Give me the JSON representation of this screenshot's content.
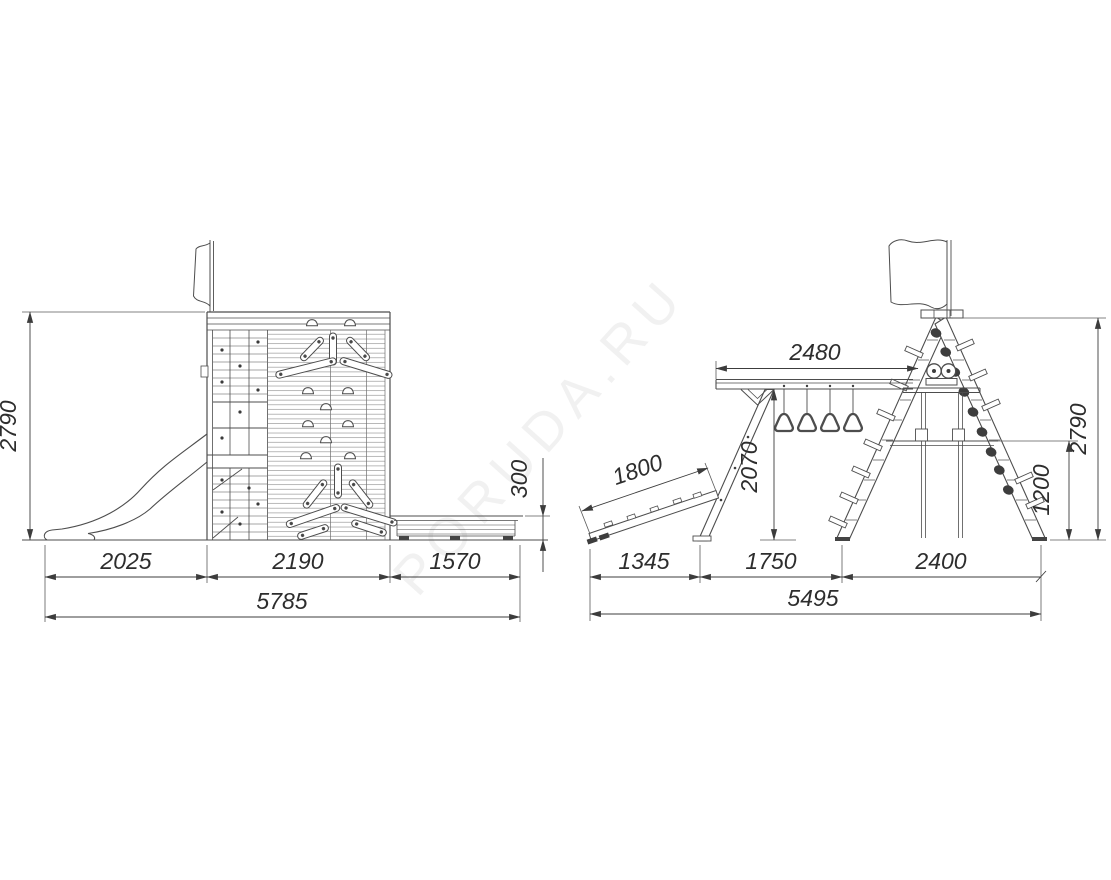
{
  "drawing": {
    "watermark": "PORUDA.RU",
    "side_view": {
      "overall_height": "2790",
      "slide_zone_length": "2025",
      "tower_width": "2190",
      "bench_zone_length": "1570",
      "overall_length": "5785",
      "bench_height": "300"
    },
    "front_view": {
      "beam_span": "2480",
      "overall_height": "2790",
      "ramp_length": "1800",
      "beam_clearance": "2070",
      "crossbar_height": "1200",
      "ramp_zone": "1345",
      "support_zone": "1750",
      "frame_base": "2400",
      "overall_length": "5495"
    }
  }
}
